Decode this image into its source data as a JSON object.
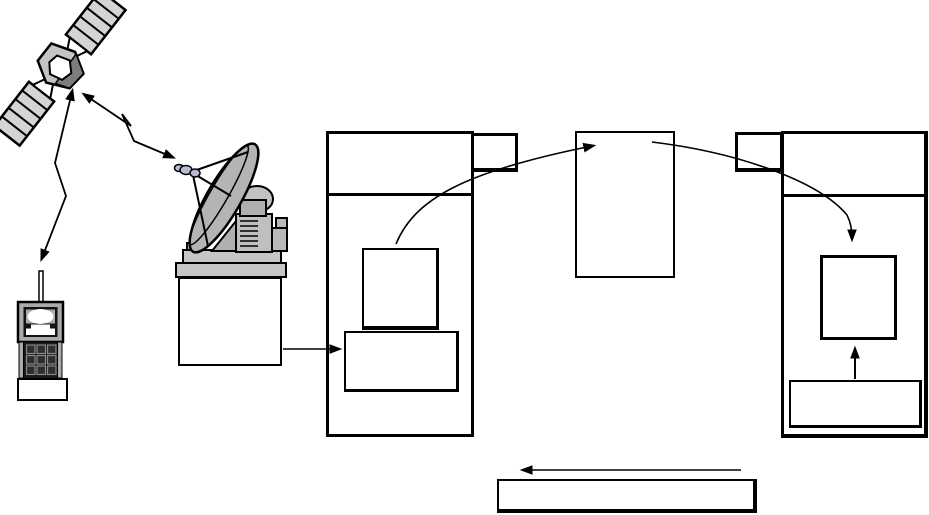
{
  "canvas": {
    "width": 929,
    "height": 515,
    "background": "#ffffff"
  },
  "colors": {
    "line": "#000000",
    "panel_gray": "#d4d4d4",
    "body_gray": "#c4c4c4",
    "facet_dark_gray": "#7d7d7d",
    "device_gray": "#ababab",
    "dish_gray": "#b4b4b4",
    "base_gray": "#c6c6c6",
    "white": "#ffffff"
  },
  "diagram": {
    "description": "Unlabeled satellite communication flow diagram: a satellite is linked by zig-zag radio arrows to a handheld terminal and to a ground-station dish; the dish station connects into a left frame of empty boxes, a curved arrow leads to a center box, another curved arrow leads into a right frame, with an upward arrow inside the right frame and a long left-pointing return arrow above a wide empty box at the bottom. All boxes are empty (no text).",
    "boxes": [
      {
        "name": "left-station-frame",
        "x": 326,
        "y": 131,
        "w": 148,
        "h": 306,
        "b": [
          3,
          3,
          3,
          3
        ]
      },
      {
        "name": "left-station-tab",
        "x": 471,
        "y": 133,
        "w": 47,
        "h": 39,
        "b": [
          3,
          3,
          4,
          3
        ]
      },
      {
        "name": "left-station-header-line",
        "x": 326,
        "y": 193,
        "w": 148,
        "h": 3,
        "solid": true
      },
      {
        "name": "left-upper-module-box",
        "x": 362,
        "y": 248,
        "w": 77,
        "h": 82,
        "b": [
          2,
          3,
          4,
          2
        ]
      },
      {
        "name": "left-lower-module-box",
        "x": 344,
        "y": 331,
        "w": 115,
        "h": 61,
        "b": [
          2,
          3,
          3,
          2
        ]
      },
      {
        "name": "center-module-box",
        "x": 575,
        "y": 131,
        "w": 100,
        "h": 147,
        "b": [
          2,
          2,
          2,
          2
        ]
      },
      {
        "name": "right-station-tab",
        "x": 735,
        "y": 132,
        "w": 48,
        "h": 40,
        "b": [
          3,
          3,
          4,
          3
        ]
      },
      {
        "name": "right-station-frame",
        "x": 781,
        "y": 131,
        "w": 147,
        "h": 307,
        "b": [
          3,
          4,
          4,
          3
        ]
      },
      {
        "name": "right-station-header-line",
        "x": 781,
        "y": 194,
        "w": 147,
        "h": 3,
        "solid": true
      },
      {
        "name": "right-inner-module-box",
        "x": 820,
        "y": 255,
        "w": 77,
        "h": 85,
        "b": [
          3,
          3,
          3,
          3
        ]
      },
      {
        "name": "right-lower-module-box",
        "x": 789,
        "y": 380,
        "w": 133,
        "h": 48,
        "b": [
          2,
          3,
          3,
          2
        ]
      },
      {
        "name": "dish-base-box",
        "x": 178,
        "y": 277,
        "w": 104,
        "h": 89,
        "b": [
          2,
          2,
          2,
          2
        ]
      },
      {
        "name": "handset-base-box",
        "x": 17,
        "y": 378,
        "w": 51,
        "h": 23,
        "b": [
          2,
          2,
          2,
          2
        ]
      },
      {
        "name": "bottom-return-box",
        "x": 497,
        "y": 479,
        "w": 260,
        "h": 34,
        "b": [
          2,
          4,
          4,
          2
        ]
      }
    ],
    "arrows": {
      "sat_phone_link": {
        "points": "72,92 55,163 66,196 42,258",
        "double": true
      },
      "sat_dish_link": {
        "points": "85,95 131,126 122,114 134,141 172,157",
        "double": true
      },
      "dish_to_station": {
        "points": "283,349 338,349"
      },
      "uplink_curve": {
        "d": "M396,244 C414,200 462,172 592,146"
      },
      "crosslink_curve": {
        "d": "M652,142 C735,152 818,180 847,215 C851,223 852,231 852,238"
      },
      "modem_up_arrow": {
        "points": "855,379 855,350"
      },
      "return_arrow": {
        "points": "741,470 524,470"
      }
    }
  },
  "icons": {
    "satellite": "satellite-clipart",
    "ground_station": "ground-station-dish-clipart",
    "handset": "satellite-handset-clipart"
  }
}
